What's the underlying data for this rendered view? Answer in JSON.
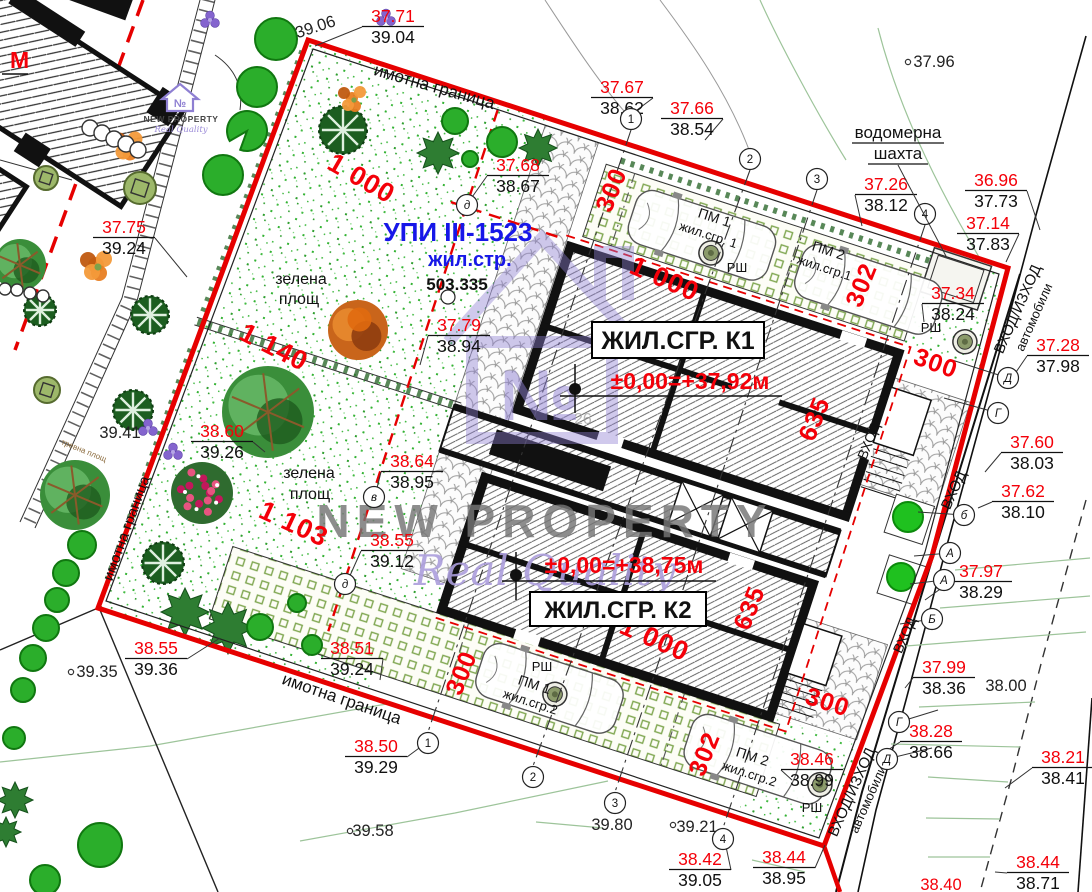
{
  "colors": {
    "red": "#F40009",
    "blue": "#1717E8",
    "black": "#111111",
    "boundary": "#E60000",
    "purple": "#8E7FD2",
    "stipple": "#33B233"
  },
  "corner_label": "М",
  "logo": {
    "brand": "NEW PROPERTY",
    "tagline": "Real Quality",
    "monogram": "№"
  },
  "watermark": {
    "brand": "NEW PROPERTY",
    "tagline": "Real Quality",
    "monogram": "№",
    "number": "26"
  },
  "parcel": {
    "upi": "УПИ III-1523",
    "zoning": "жил.стр.",
    "area": "503.335"
  },
  "buildings": [
    {
      "name": "ЖИЛ.СГР. К1",
      "level": "±0,00=+37,92м"
    },
    {
      "name": "ЖИЛ.СГР. К2",
      "level": "±0,00=+38,75м"
    }
  ],
  "water_shaft": {
    "line1": "водомерна",
    "line2": "шахта"
  },
  "spot_pairs": [
    {
      "red": "37.71",
      "black": "39.04",
      "x": 393,
      "y": 22,
      "tx": 315,
      "ty": 46
    },
    {
      "red": "37.67",
      "black": "38.62",
      "x": 622,
      "y": 93,
      "tx": 633,
      "ty": 113
    },
    {
      "red": "37.66",
      "black": "38.54",
      "x": 692,
      "y": 114,
      "tx": 705,
      "ty": 140
    },
    {
      "red": "37.26",
      "black": "38.12",
      "x": 886,
      "y": 190,
      "tx": 862,
      "ty": 226
    },
    {
      "red": "36.96",
      "black": "37.73",
      "x": 996,
      "y": 186,
      "tx": 1040,
      "ty": 230
    },
    {
      "red": "37.14",
      "black": "37.83",
      "x": 988,
      "y": 229,
      "tx": 1006,
      "ty": 262
    },
    {
      "red": "37.34",
      "black": "38.24",
      "x": 953,
      "y": 299,
      "tx": 924,
      "ty": 322
    },
    {
      "red": "37.28",
      "black": "37.98",
      "x": 1058,
      "y": 351,
      "tx": 1014,
      "ty": 375
    },
    {
      "red": "37.60",
      "black": "38.03",
      "x": 1032,
      "y": 448,
      "tx": 985,
      "ty": 472
    },
    {
      "red": "37.62",
      "black": "38.10",
      "x": 1023,
      "y": 497,
      "tx": 978,
      "ty": 508
    },
    {
      "red": "37.97",
      "black": "38.29",
      "x": 981,
      "y": 577,
      "tx": 925,
      "ty": 600
    },
    {
      "red": "37.99",
      "black": "38.36",
      "x": 944,
      "y": 673,
      "tx": 905,
      "ty": 688
    },
    {
      "red": "38.28",
      "black": "38.66",
      "x": 931,
      "y": 737,
      "tx": 885,
      "ty": 752
    },
    {
      "red": "38.21",
      "black": "38.41",
      "x": 1063,
      "y": 763,
      "tx": 1005,
      "ty": 788
    },
    {
      "red": "38.44",
      "black": "38.71",
      "x": 1038,
      "y": 868,
      "tx": 995,
      "ty": 872
    },
    {
      "red": "38.44",
      "black": "38.95",
      "x": 784,
      "y": 863,
      "tx": 825,
      "ty": 845
    },
    {
      "red": "38.42",
      "black": "39.05",
      "x": 700,
      "y": 865,
      "tx": 725,
      "ty": 842
    },
    {
      "red": "38.46",
      "black": "38.99",
      "x": 812,
      "y": 765,
      "tx": 792,
      "ty": 780
    },
    {
      "red": "38.50",
      "black": "39.29",
      "x": 376,
      "y": 752,
      "tx": 430,
      "ty": 740
    },
    {
      "red": "38.55",
      "black": "39.36",
      "x": 156,
      "y": 654,
      "tx": 220,
      "ty": 638
    },
    {
      "red": "38.51",
      "black": "39.24",
      "x": 352,
      "y": 654,
      "tx": 380,
      "ty": 680
    },
    {
      "red": "38.60",
      "black": "39.26",
      "x": 222,
      "y": 437,
      "tx": 265,
      "ty": 452
    },
    {
      "red": "37.75",
      "black": "39.24",
      "x": 124,
      "y": 233,
      "tx": 187,
      "ty": 277
    },
    {
      "red": "38.64",
      "black": "38.95",
      "x": 412,
      "y": 467,
      "tx": 376,
      "ty": 492
    },
    {
      "red": "38.55",
      "black": "39.12",
      "x": 392,
      "y": 546,
      "tx": 348,
      "ty": 580
    },
    {
      "red": "37.79",
      "black": "38.94",
      "x": 459,
      "y": 331,
      "tx": 420,
      "ty": 365
    },
    {
      "red": "37.68",
      "black": "38.67",
      "x": 518,
      "y": 171,
      "tx": 470,
      "ty": 200
    }
  ],
  "spot_singles": [
    {
      "t": "39.06",
      "x": 317,
      "y": 32,
      "rot": -18
    },
    {
      "t": "37.96",
      "x": 934,
      "y": 67,
      "dx": 908,
      "dy": 62
    },
    {
      "t": "39.35",
      "x": 97,
      "y": 677,
      "dx": 71,
      "dy": 672
    },
    {
      "t": "39.58",
      "x": 373,
      "y": 836,
      "dx": 350,
      "dy": 831
    },
    {
      "t": "39.80",
      "x": 612,
      "y": 830
    },
    {
      "t": "39.21",
      "x": 697,
      "y": 832,
      "dx": 673,
      "dy": 825
    },
    {
      "t": "38.00",
      "x": 1006,
      "y": 691
    },
    {
      "t": "39.41",
      "x": 120,
      "y": 438
    },
    {
      "t": "38.40",
      "x": 941,
      "y": 890,
      "red": true
    }
  ],
  "dims": [
    {
      "t": "1 000",
      "x": 357,
      "y": 186,
      "rot": 30,
      "size": 27
    },
    {
      "t": "1 140",
      "x": 270,
      "y": 355,
      "rot": 27,
      "size": 27
    },
    {
      "t": "1 103",
      "x": 290,
      "y": 532,
      "rot": 25,
      "size": 27
    },
    {
      "t": "1 000",
      "x": 661,
      "y": 287,
      "rot": 24,
      "size": 27
    },
    {
      "t": "1 000",
      "x": 651,
      "y": 647,
      "rot": 24,
      "size": 27
    },
    {
      "t": "300",
      "x": 619,
      "y": 193,
      "rot": -68,
      "size": 25
    },
    {
      "t": "302",
      "x": 869,
      "y": 288,
      "rot": -68,
      "size": 25
    },
    {
      "t": "300",
      "x": 933,
      "y": 371,
      "rot": 20,
      "size": 25
    },
    {
      "t": "635",
      "x": 822,
      "y": 422,
      "rot": -68,
      "size": 25
    },
    {
      "t": "635",
      "x": 757,
      "y": 611,
      "rot": -68,
      "size": 25
    },
    {
      "t": "300",
      "x": 469,
      "y": 676,
      "rot": -68,
      "size": 25
    },
    {
      "t": "302",
      "x": 712,
      "y": 757,
      "rot": -68,
      "size": 25
    },
    {
      "t": "300",
      "x": 825,
      "y": 710,
      "rot": 18,
      "size": 25
    }
  ],
  "text_labels": [
    {
      "t": "имотна граница",
      "x": 433,
      "y": 92,
      "rot": 16,
      "size": 17
    },
    {
      "t": "имотна граница",
      "x": 340,
      "y": 704,
      "rot": 19,
      "size": 17
    },
    {
      "t": "имотна граница",
      "x": 131,
      "y": 530,
      "rot": -70,
      "size": 15
    },
    {
      "t": "зелена",
      "x": 301,
      "y": 284,
      "size": 16
    },
    {
      "t": "площ",
      "x": 299,
      "y": 304,
      "size": 16
    },
    {
      "t": "зелена",
      "x": 309,
      "y": 478,
      "size": 16
    },
    {
      "t": "площ",
      "x": 310,
      "y": 499,
      "size": 16
    },
    {
      "t": "ПМ 1",
      "x": 713,
      "y": 222,
      "rot": 18,
      "size": 14
    },
    {
      "t": "жил.сгр. 1",
      "x": 707,
      "y": 239,
      "rot": 18,
      "size": 13
    },
    {
      "t": "ПМ 2",
      "x": 827,
      "y": 255,
      "rot": 18,
      "size": 14
    },
    {
      "t": "жил.сгр.1",
      "x": 823,
      "y": 272,
      "rot": 18,
      "size": 13
    },
    {
      "t": "ПМ 1",
      "x": 533,
      "y": 689,
      "rot": 18,
      "size": 14
    },
    {
      "t": "жил.сгр.2",
      "x": 529,
      "y": 706,
      "rot": 18,
      "size": 13
    },
    {
      "t": "ПМ 2",
      "x": 751,
      "y": 761,
      "rot": 18,
      "size": 14
    },
    {
      "t": "жил.сгр.2",
      "x": 748,
      "y": 778,
      "rot": 18,
      "size": 13
    },
    {
      "t": "РШ",
      "x": 737,
      "y": 272,
      "size": 13
    },
    {
      "t": "РШ",
      "x": 931,
      "y": 332,
      "size": 13
    },
    {
      "t": "РШ",
      "x": 542,
      "y": 671,
      "size": 13
    },
    {
      "t": "РШ",
      "x": 812,
      "y": 812,
      "size": 13
    },
    {
      "t": "ВХОД",
      "x": 873,
      "y": 443,
      "rot": -68,
      "size": 14
    },
    {
      "t": "ВХОД",
      "x": 958,
      "y": 492,
      "rot": -66,
      "size": 15
    },
    {
      "t": "ВХОД",
      "x": 909,
      "y": 637,
      "rot": -66,
      "size": 14
    },
    {
      "t": "ВХОД/ИЗХОД",
      "x": 1022,
      "y": 311,
      "rot": -66,
      "size": 15
    },
    {
      "t": "автомобили",
      "x": 1038,
      "y": 319,
      "rot": -66,
      "size": 13
    },
    {
      "t": "ВХОД/ИЗХОД",
      "x": 856,
      "y": 794,
      "rot": -66,
      "size": 15
    },
    {
      "t": "автомобили",
      "x": 872,
      "y": 801,
      "rot": -66,
      "size": 13
    },
    {
      "t": "тревна площ",
      "x": 83,
      "y": 453,
      "rot": 22,
      "size": 8,
      "color": "#8B6B3D"
    }
  ],
  "circled": [
    {
      "t": "1",
      "x": 631,
      "y": 119
    },
    {
      "t": "2",
      "x": 750,
      "y": 159
    },
    {
      "t": "3",
      "x": 817,
      "y": 179
    },
    {
      "t": "4",
      "x": 925,
      "y": 214
    },
    {
      "t": "1",
      "x": 428,
      "y": 743
    },
    {
      "t": "2",
      "x": 533,
      "y": 777
    },
    {
      "t": "3",
      "x": 615,
      "y": 803
    },
    {
      "t": "4",
      "x": 723,
      "y": 839
    },
    {
      "t": "Д",
      "x": 1008,
      "y": 378
    },
    {
      "t": "Г",
      "x": 998,
      "y": 413
    },
    {
      "t": "б",
      "x": 964,
      "y": 515
    },
    {
      "t": "А",
      "x": 950,
      "y": 553
    },
    {
      "t": "А",
      "x": 944,
      "y": 580
    },
    {
      "t": "Б",
      "x": 932,
      "y": 619
    },
    {
      "t": "Г",
      "x": 899,
      "y": 722
    },
    {
      "t": "Д",
      "x": 887,
      "y": 759
    },
    {
      "t": "д",
      "x": 467,
      "y": 205
    },
    {
      "t": "в",
      "x": 374,
      "y": 497
    },
    {
      "t": "д",
      "x": 345,
      "y": 584
    },
    {
      "t": "",
      "x": 448,
      "y": 297
    }
  ],
  "trees": [
    {
      "t": "circle",
      "x": 276,
      "y": 39,
      "r": 21
    },
    {
      "t": "circle",
      "x": 257,
      "y": 87,
      "r": 20
    },
    {
      "t": "notch",
      "x": 247,
      "y": 131,
      "r": 20
    },
    {
      "t": "circle",
      "x": 223,
      "y": 175,
      "r": 20
    },
    {
      "t": "circle",
      "x": 82,
      "y": 545,
      "r": 14
    },
    {
      "t": "circle",
      "x": 66,
      "y": 573,
      "r": 13
    },
    {
      "t": "circle",
      "x": 57,
      "y": 600,
      "r": 12
    },
    {
      "t": "circle",
      "x": 46,
      "y": 628,
      "r": 13
    },
    {
      "t": "circle",
      "x": 33,
      "y": 658,
      "r": 13
    },
    {
      "t": "circle",
      "x": 23,
      "y": 690,
      "r": 12
    },
    {
      "t": "circle",
      "x": 14,
      "y": 738,
      "r": 11
    },
    {
      "t": "circle",
      "x": 100,
      "y": 845,
      "r": 22
    },
    {
      "t": "circle",
      "x": 45,
      "y": 880,
      "r": 15
    },
    {
      "t": "conifer",
      "x": 343,
      "y": 130,
      "r": 24
    },
    {
      "t": "conifer",
      "x": 150,
      "y": 315,
      "r": 19
    },
    {
      "t": "conifer",
      "x": 133,
      "y": 410,
      "r": 20
    },
    {
      "t": "conifer",
      "x": 163,
      "y": 563,
      "r": 21
    },
    {
      "t": "circle",
      "x": 455,
      "y": 121,
      "r": 13
    },
    {
      "t": "circle",
      "x": 502,
      "y": 142,
      "r": 15
    },
    {
      "t": "circle",
      "x": 470,
      "y": 159,
      "r": 8
    },
    {
      "t": "spiky",
      "x": 438,
      "y": 153,
      "r": 21
    },
    {
      "t": "spiky",
      "x": 538,
      "y": 148,
      "r": 19
    },
    {
      "t": "orange",
      "x": 358,
      "y": 330,
      "r": 30
    },
    {
      "t": "mixed",
      "x": 268,
      "y": 412,
      "r": 46
    },
    {
      "t": "pink",
      "x": 202,
      "y": 493,
      "r": 31
    },
    {
      "t": "spiky",
      "x": 185,
      "y": 612,
      "r": 24
    },
    {
      "t": "spiky",
      "x": 228,
      "y": 628,
      "r": 26
    },
    {
      "t": "circle",
      "x": 260,
      "y": 627,
      "r": 13
    },
    {
      "t": "circle",
      "x": 297,
      "y": 603,
      "r": 9
    },
    {
      "t": "circle",
      "x": 312,
      "y": 645,
      "r": 10
    },
    {
      "t": "bright",
      "x": 908,
      "y": 517,
      "r": 15
    },
    {
      "t": "bright",
      "x": 901,
      "y": 577,
      "r": 14
    },
    {
      "t": "floret",
      "x": 386,
      "y": 18,
      "r": 9
    },
    {
      "t": "floret",
      "x": 210,
      "y": 20,
      "r": 9
    },
    {
      "t": "floret",
      "x": 148,
      "y": 428,
      "r": 8
    },
    {
      "t": "floret",
      "x": 173,
      "y": 452,
      "r": 8
    },
    {
      "t": "orangebush",
      "x": 127,
      "y": 145,
      "r": 15
    },
    {
      "t": "orangebush",
      "x": 96,
      "y": 265,
      "r": 16
    },
    {
      "t": "orangebush",
      "x": 352,
      "y": 98,
      "r": 12
    },
    {
      "t": "olive",
      "x": 140,
      "y": 188,
      "r": 16
    },
    {
      "t": "olive",
      "x": 46,
      "y": 178,
      "r": 12
    },
    {
      "t": "olive",
      "x": 47,
      "y": 390,
      "r": 13
    },
    {
      "t": "mixed",
      "x": 75,
      "y": 495,
      "r": 35
    },
    {
      "t": "mixed",
      "x": 20,
      "y": 265,
      "r": 26
    },
    {
      "t": "conifer",
      "x": 40,
      "y": 310,
      "r": 16
    },
    {
      "t": "spiky",
      "x": 15,
      "y": 800,
      "r": 18
    },
    {
      "t": "spiky",
      "x": 6,
      "y": 832,
      "r": 15
    },
    {
      "t": "ring",
      "x": 90,
      "y": 128,
      "r": 8
    },
    {
      "t": "ring",
      "x": 102,
      "y": 133,
      "r": 8
    },
    {
      "t": "ring",
      "x": 114,
      "y": 139,
      "r": 8
    },
    {
      "t": "ring",
      "x": 126,
      "y": 144,
      "r": 8
    },
    {
      "t": "ring",
      "x": 138,
      "y": 150,
      "r": 8
    },
    {
      "t": "ring",
      "x": 5,
      "y": 289,
      "r": 6
    },
    {
      "t": "ring",
      "x": 17,
      "y": 290,
      "r": 6
    },
    {
      "t": "ring",
      "x": 30,
      "y": 293,
      "r": 6
    },
    {
      "t": "ring",
      "x": 43,
      "y": 296,
      "r": 6
    }
  ]
}
